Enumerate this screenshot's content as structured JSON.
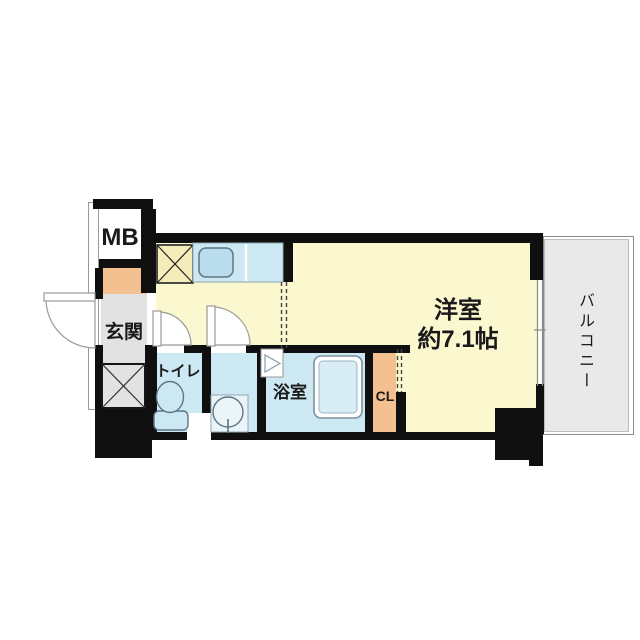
{
  "floorplan": {
    "type": "apartment-floor-plan",
    "labels": {
      "meter_box": "MB",
      "entrance": "玄関",
      "toilet": "トイレ",
      "bathroom": "浴室",
      "closet": "CL",
      "main_room": "洋室",
      "main_room_size": "約7.1帖",
      "balcony": "バルコニー"
    },
    "colors": {
      "wall": "#0f0f0f",
      "floor_yellow": "#fbf7cf",
      "wet_blue": "#cce8f2",
      "orange": "#f5c08f",
      "entrance_gray": "#e2e2e2",
      "balcony_gray": "#e9e9e9",
      "stove_yellow": "#f4ecba",
      "fixture_stroke": "#5d7585",
      "door_stroke": "#999999"
    }
  }
}
